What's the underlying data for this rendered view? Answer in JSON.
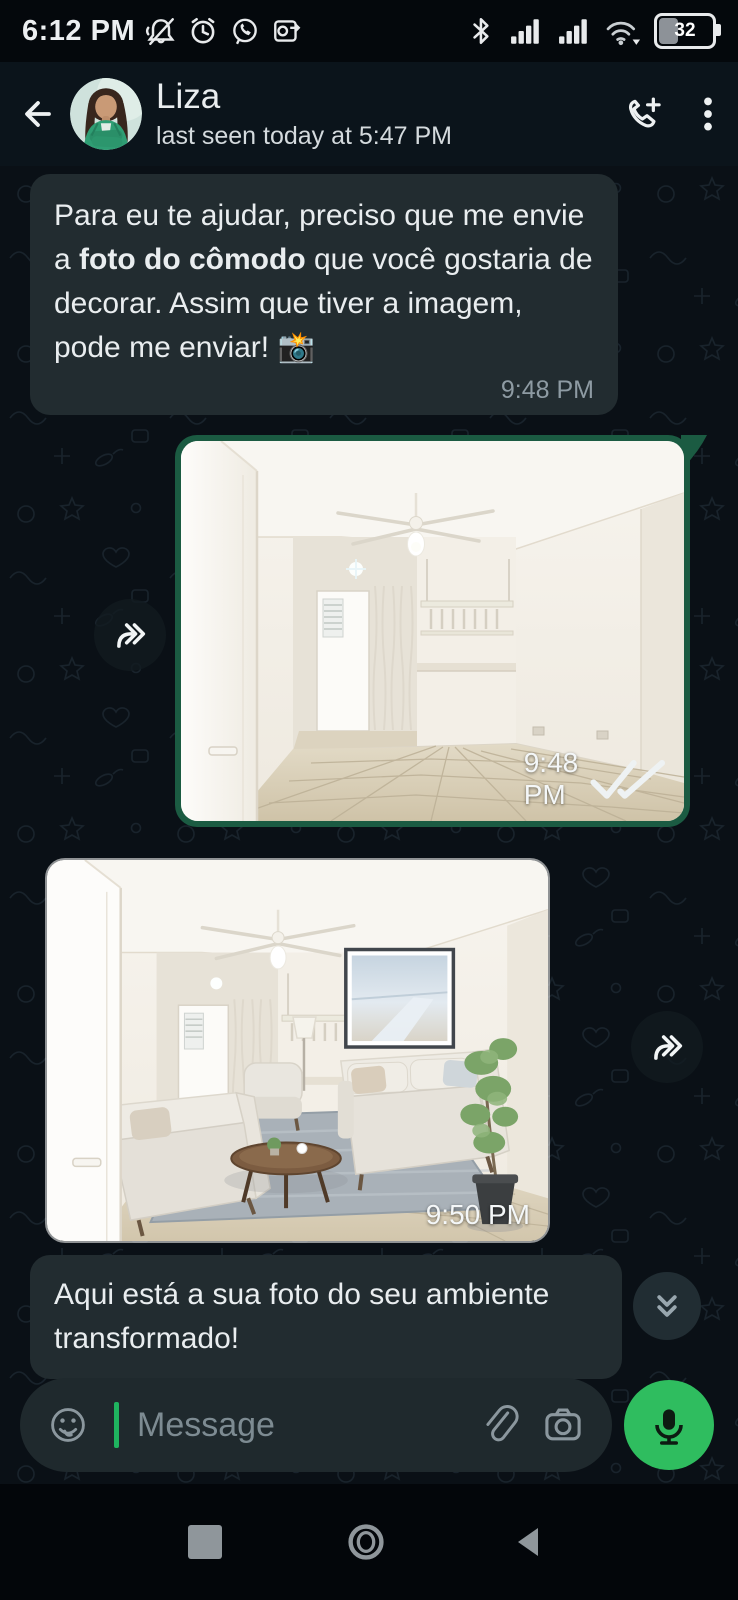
{
  "status_bar": {
    "time": "6:12 PM",
    "battery_percent": "32",
    "left_icon_names": [
      "notifications-muted-icon",
      "alarm-icon",
      "whatsapp-icon",
      "outlook-icon"
    ],
    "right_icon_names": [
      "bluetooth-icon",
      "cell-signal-sim1-icon",
      "cell-signal-sim2-icon",
      "wifi-icon",
      "battery-icon"
    ]
  },
  "header": {
    "contact_name": "Liza",
    "presence": "last seen today at 5:47 PM"
  },
  "messages": {
    "m1": {
      "seg_pre": "Para eu te ajudar, preciso que me envie a ",
      "seg_bold": "foto do cômodo",
      "seg_post": " que você gostaria de decorar. Assim que tiver a imagem, pode me enviar! 📸",
      "time": "9:48 PM"
    },
    "m2": {
      "time": "9:48 PM",
      "alt": "Empty living room: white walls, ceiling fan, open door, kitchen pass-through, beige tiled floor"
    },
    "m3": {
      "time": "9:50 PM",
      "alt": "Same room furnished: two light sofas, armchair, round coffee table, gray rug, wall art, potted plant"
    },
    "m4": {
      "text": "Aqui está a sua foto do seu ambiente transformado!"
    }
  },
  "composer": {
    "placeholder": "Message"
  },
  "colors": {
    "outgoing_frame": "#1b5b42",
    "incoming_bubble": "#222c30",
    "mic_button_green": "#2fbd5f",
    "cursor_green": "#1fb35f",
    "timestamp_gray": "#8e9ba3",
    "chat_background": "#0a1016"
  }
}
